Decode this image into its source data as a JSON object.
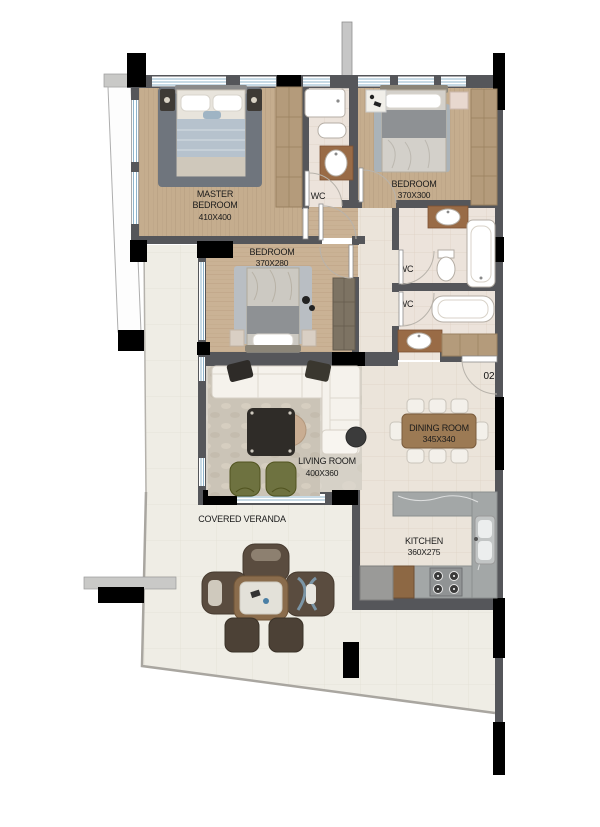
{
  "plan": {
    "rooms": {
      "master_bedroom": {
        "line1": "MASTER",
        "line2": "BEDROOM",
        "dims": "410X400"
      },
      "bedroom_top": {
        "name": "BEDROOM",
        "dims": "370X300"
      },
      "bedroom_mid": {
        "name": "BEDROOM",
        "dims": "370X280"
      },
      "living_room": {
        "name": "LIVING ROOM",
        "dims": "400X360"
      },
      "dining_room": {
        "name": "DINING ROOM",
        "dims": "345X340"
      },
      "kitchen": {
        "name": "KITCHEN",
        "dims": "360X275"
      },
      "veranda": {
        "name": "COVERED VERANDA"
      },
      "wc_top": {
        "name": "WC"
      },
      "wc_right_upper": {
        "name": "WC"
      },
      "wc_right_lower": {
        "name": "WC"
      }
    },
    "entrance": {
      "door_label": "02"
    },
    "colors": {
      "wall": "#55565a",
      "column": "#000000",
      "wood_floor": "#c5ad8e",
      "tile_floor": "#ebe4da",
      "wc_floor": "#ece3db",
      "living_floor": "#d6d1c7",
      "veranda_floor": "#efede5",
      "window": "#8fb4cb",
      "armchair_accent": "#6e7240",
      "dining_table": "#9c7a54"
    }
  }
}
